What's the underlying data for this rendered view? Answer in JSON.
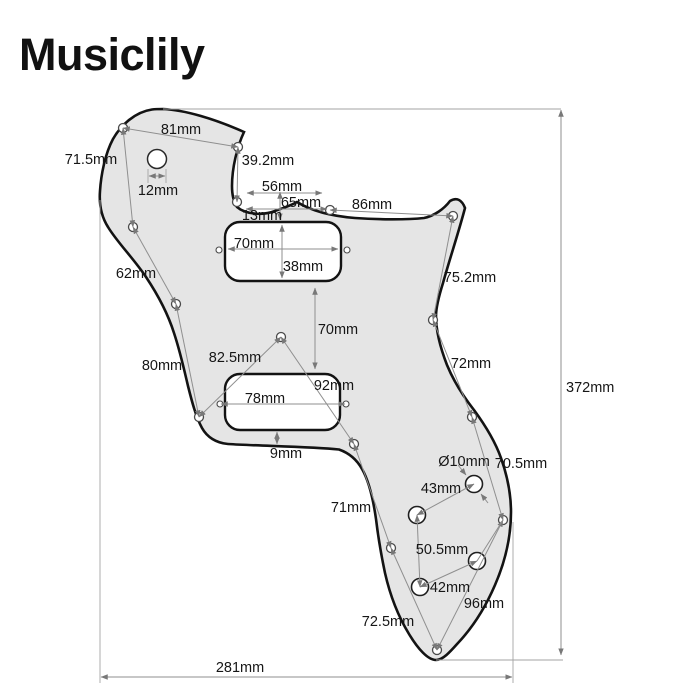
{
  "brand": {
    "logo_text": "Musiclily"
  },
  "diagram": {
    "colors": {
      "background": "#ffffff",
      "pickguard_fill": "#e5e5e5",
      "outline": "#131313",
      "dimension_line": "#8f8f8f",
      "label_text": "#161616"
    },
    "dimensions": {
      "d81": {
        "text": "81mm"
      },
      "d71_5": {
        "text": "71.5mm"
      },
      "d12": {
        "text": "12mm"
      },
      "d39_2": {
        "text": "39.2mm"
      },
      "d56": {
        "text": "56mm"
      },
      "d65": {
        "text": "65mm"
      },
      "d13": {
        "text": "13mm"
      },
      "d86": {
        "text": "86mm"
      },
      "d70_neck": {
        "text": "70mm"
      },
      "d38": {
        "text": "38mm"
      },
      "d62": {
        "text": "62mm"
      },
      "d75_2": {
        "text": "75.2mm"
      },
      "d70_gap": {
        "text": "70mm"
      },
      "d72": {
        "text": "72mm"
      },
      "d80": {
        "text": "80mm"
      },
      "d82_5": {
        "text": "82.5mm"
      },
      "d92": {
        "text": "92mm"
      },
      "d78": {
        "text": "78mm"
      },
      "d9": {
        "text": "9mm"
      },
      "d10_dia": {
        "text": "Ø10mm"
      },
      "d70_5": {
        "text": "70.5mm"
      },
      "d43": {
        "text": "43mm"
      },
      "d71": {
        "text": "71mm"
      },
      "d50_5": {
        "text": "50.5mm"
      },
      "d42": {
        "text": "42mm"
      },
      "d96": {
        "text": "96mm"
      },
      "d72_5": {
        "text": "72.5mm"
      },
      "d281": {
        "text": "281mm"
      },
      "d372": {
        "text": "372mm"
      }
    }
  }
}
